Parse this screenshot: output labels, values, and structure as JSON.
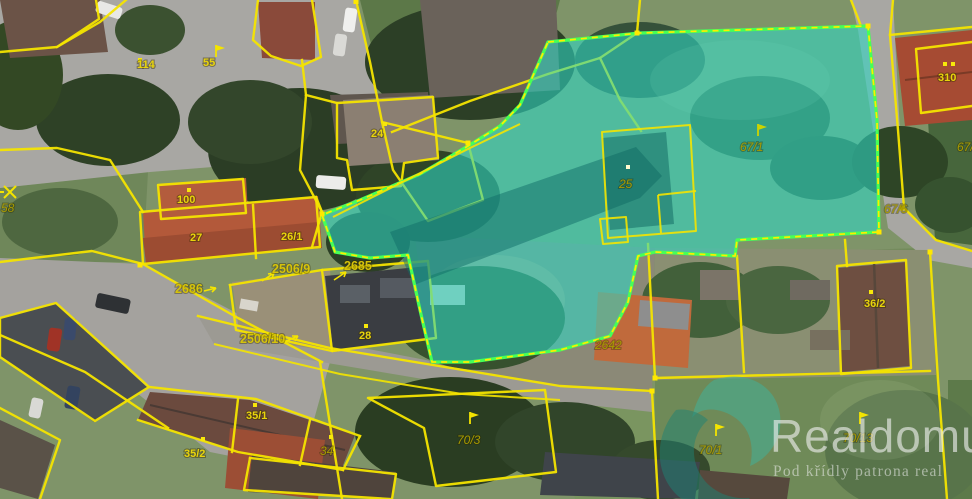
{
  "watermark": {
    "brand": "Realdomus",
    "tagline": "Pod křídly patrona real"
  },
  "selection": {
    "highlighted_parcels": [
      "25",
      "67/1"
    ],
    "fill_color": "#2ed8c5",
    "border_color": "#46ff57"
  },
  "map_colors": {
    "boundary_line": "#f4e400",
    "label_building": "#e8d40c",
    "label_street": "#d6c30a",
    "label_land": "#a89a00"
  },
  "labels": [
    {
      "text": "114",
      "kind": "building"
    },
    {
      "text": "55",
      "kind": "building"
    },
    {
      "text": "24",
      "kind": "building"
    },
    {
      "text": "100",
      "kind": "building"
    },
    {
      "text": "27",
      "kind": "building"
    },
    {
      "text": "26/1",
      "kind": "building"
    },
    {
      "text": "2506/9",
      "kind": "land"
    },
    {
      "text": "2685",
      "kind": "land"
    },
    {
      "text": "2686",
      "kind": "land"
    },
    {
      "text": "2506/10",
      "kind": "land"
    },
    {
      "text": "28",
      "kind": "building"
    },
    {
      "text": "25",
      "kind": "building-selected"
    },
    {
      "text": "67/1",
      "kind": "land-selected"
    },
    {
      "text": "310",
      "kind": "building"
    },
    {
      "text": "67/7",
      "kind": "land"
    },
    {
      "text": "67/6",
      "kind": "land"
    },
    {
      "text": "36/2",
      "kind": "building"
    },
    {
      "text": "2642",
      "kind": "land"
    },
    {
      "text": "70/3",
      "kind": "land"
    },
    {
      "text": "70/1",
      "kind": "land"
    },
    {
      "text": "70/13",
      "kind": "land"
    },
    {
      "text": "35/1",
      "kind": "building"
    },
    {
      "text": "35/2",
      "kind": "building"
    },
    {
      "text": "34",
      "kind": "land"
    },
    {
      "text": "58",
      "kind": "land"
    }
  ]
}
